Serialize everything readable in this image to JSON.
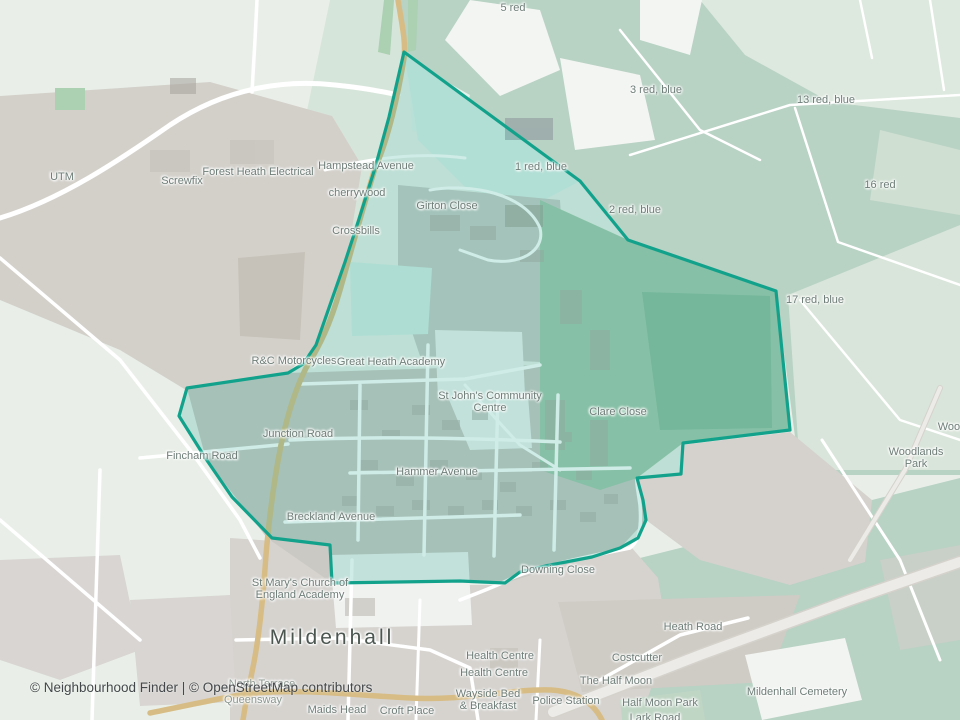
{
  "map": {
    "town": "Mildenhall",
    "attribution": "© Neighbourhood Finder | © OpenStreetMap contributors",
    "boundary": {
      "name": "neighbourhood-boundary",
      "stroke": "#12a28c",
      "fill": "rgba(26,164,143,0.21)",
      "stroke_width": 3.2,
      "points": [
        [
          404,
          52
        ],
        [
          580,
          181
        ],
        [
          628,
          240
        ],
        [
          776,
          291
        ],
        [
          790,
          430
        ],
        [
          683,
          443
        ],
        [
          681,
          474
        ],
        [
          637,
          478
        ],
        [
          643,
          500
        ],
        [
          646,
          520
        ],
        [
          638,
          538
        ],
        [
          620,
          548
        ],
        [
          592,
          557
        ],
        [
          545,
          566
        ],
        [
          520,
          572
        ],
        [
          505,
          583
        ],
        [
          460,
          581
        ],
        [
          332,
          583
        ],
        [
          330,
          545
        ],
        [
          272,
          538
        ],
        [
          232,
          497
        ],
        [
          206,
          459
        ],
        [
          179,
          416
        ],
        [
          187,
          388
        ],
        [
          288,
          373
        ],
        [
          303,
          364
        ],
        [
          316,
          345
        ],
        [
          331,
          302
        ],
        [
          345,
          262
        ],
        [
          359,
          219
        ],
        [
          375,
          168
        ],
        [
          389,
          117
        ]
      ]
    },
    "labels": [
      {
        "text": "UTM",
        "x": 62,
        "y": 177
      },
      {
        "text": "Screwfix",
        "x": 182,
        "y": 181
      },
      {
        "text": "Forest Heath Electrical",
        "x": 258,
        "y": 172
      },
      {
        "text": "Hampstead Avenue",
        "x": 366,
        "y": 166
      },
      {
        "text": "cherrywood",
        "x": 357,
        "y": 193
      },
      {
        "text": "Crossbills",
        "x": 356,
        "y": 231
      },
      {
        "text": "Girton Close",
        "x": 447,
        "y": 206
      },
      {
        "text": "5 red",
        "x": 513,
        "y": 8
      },
      {
        "text": "1 red, blue",
        "x": 541,
        "y": 167
      },
      {
        "text": "2 red, blue",
        "x": 635,
        "y": 210
      },
      {
        "text": "3 red, blue",
        "x": 656,
        "y": 90
      },
      {
        "text": "13 red, blue",
        "x": 826,
        "y": 100
      },
      {
        "text": "16 red",
        "x": 880,
        "y": 185
      },
      {
        "text": "17 red, blue",
        "x": 815,
        "y": 300
      },
      {
        "text": "Wood",
        "x": 952,
        "y": 427
      },
      {
        "text": "Woodlands Park",
        "x": 916,
        "y": 458
      },
      {
        "text": "R&C Motorcycles",
        "x": 294,
        "y": 361
      },
      {
        "text": "Great Heath Academy",
        "x": 391,
        "y": 362
      },
      {
        "text": "St John's Community\nCentre",
        "x": 490,
        "y": 402
      },
      {
        "text": "Clare Close",
        "x": 618,
        "y": 412
      },
      {
        "text": "Junction Road",
        "x": 298,
        "y": 434
      },
      {
        "text": "Fincham Road",
        "x": 202,
        "y": 456
      },
      {
        "text": "Hammer Avenue",
        "x": 437,
        "y": 472
      },
      {
        "text": "Breckland Avenue",
        "x": 331,
        "y": 517
      },
      {
        "text": "Downing Close",
        "x": 558,
        "y": 570
      },
      {
        "text": "St Mary's Church of\nEngland Academy",
        "x": 300,
        "y": 589
      },
      {
        "text": "Mildenhall",
        "x": 332,
        "y": 638,
        "cls": "town"
      },
      {
        "text": "Heath Road",
        "x": 693,
        "y": 627
      },
      {
        "text": "Costcutter",
        "x": 637,
        "y": 658
      },
      {
        "text": "The Half Moon",
        "x": 616,
        "y": 681
      },
      {
        "text": "Police Station",
        "x": 566,
        "y": 701
      },
      {
        "text": "Half Moon Park",
        "x": 660,
        "y": 703
      },
      {
        "text": "Lark Road",
        "x": 655,
        "y": 718
      },
      {
        "text": "Mildenhall Cemetery",
        "x": 797,
        "y": 692
      },
      {
        "text": "Health Centre",
        "x": 500,
        "y": 656
      },
      {
        "text": "Health Centre",
        "x": 494,
        "y": 673
      },
      {
        "text": "Wayside Bed\n& Breakfast",
        "x": 488,
        "y": 700
      },
      {
        "text": "Croft Place",
        "x": 407,
        "y": 711
      },
      {
        "text": "North Terrace",
        "x": 262,
        "y": 684,
        "cls": "faint"
      },
      {
        "text": "Queensway",
        "x": 253,
        "y": 700,
        "cls": "faint"
      },
      {
        "text": "Maids Head",
        "x": 337,
        "y": 710
      }
    ],
    "colors": {
      "background": "#e9efe8",
      "field_green": "#b8d2c4",
      "pale_green": "#dde8de",
      "urban_gray": "#d4d1cc",
      "road_white": "#ffffff",
      "road_tan": "#d7bd85",
      "boundary_teal": "#12a28c"
    }
  }
}
